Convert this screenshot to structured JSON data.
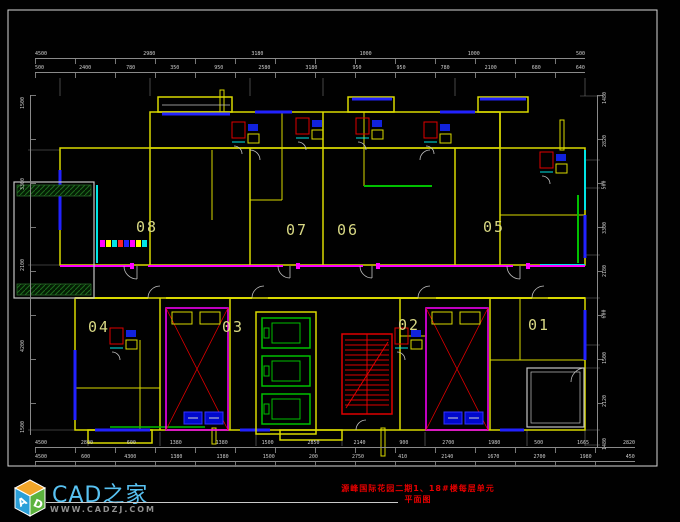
{
  "sheet": {
    "background": "#010101",
    "frame_color": "#d6d6d6"
  },
  "title": {
    "text": "源峰国际花园二期1、18#楼每层单元平面图",
    "color": "#e80000"
  },
  "logo": {
    "site_name": "CAD之家",
    "site_url": "WWW.CADZJ.COM",
    "cube_letter_left": "A",
    "cube_letter_right": "D",
    "name_color": "#58c2f2",
    "url_color": "#909090"
  },
  "rooms": [
    {
      "label": "08"
    },
    {
      "label": "07"
    },
    {
      "label": "06"
    },
    {
      "label": "05"
    },
    {
      "label": "04"
    },
    {
      "label": "03"
    },
    {
      "label": "02"
    },
    {
      "label": "01"
    }
  ],
  "dimensions": {
    "top_row_1": [
      "4500",
      "2980",
      "3180",
      "1000",
      "1000",
      "500"
    ],
    "top_row_2": [
      "500",
      "2400",
      "780",
      "350",
      "950",
      "2580",
      "3180",
      "950",
      "950",
      "780",
      "2100",
      "680",
      "640"
    ],
    "bottom_row_1": [
      "4500",
      "2800",
      "600",
      "1380",
      "1380",
      "1500",
      "2850",
      "2140",
      "900",
      "2700",
      "1980",
      "500",
      "1665",
      "2820"
    ],
    "bottom_row_2": [
      "4500",
      "600",
      "4300",
      "1380",
      "1380",
      "1500",
      "200",
      "2750",
      "410",
      "2140",
      "1670",
      "2700",
      "1980",
      "450"
    ],
    "left_column": [
      "1500",
      "3300",
      "2100",
      "4200",
      "1500"
    ],
    "right_column": [
      "1480",
      "2820",
      "500",
      "3300",
      "2180",
      "600",
      "1500",
      "2120",
      "1480"
    ]
  },
  "colors": {
    "wall_yellow": "#d9d900",
    "wall_magenta": "#ff00ff",
    "window_blue": "#2222ff",
    "wall_cyan": "#00e5e5",
    "elevator_green": "#00c000",
    "stair_red": "#e00000",
    "outline_gray": "#c4c4c4",
    "room_label": "#d8d884"
  }
}
